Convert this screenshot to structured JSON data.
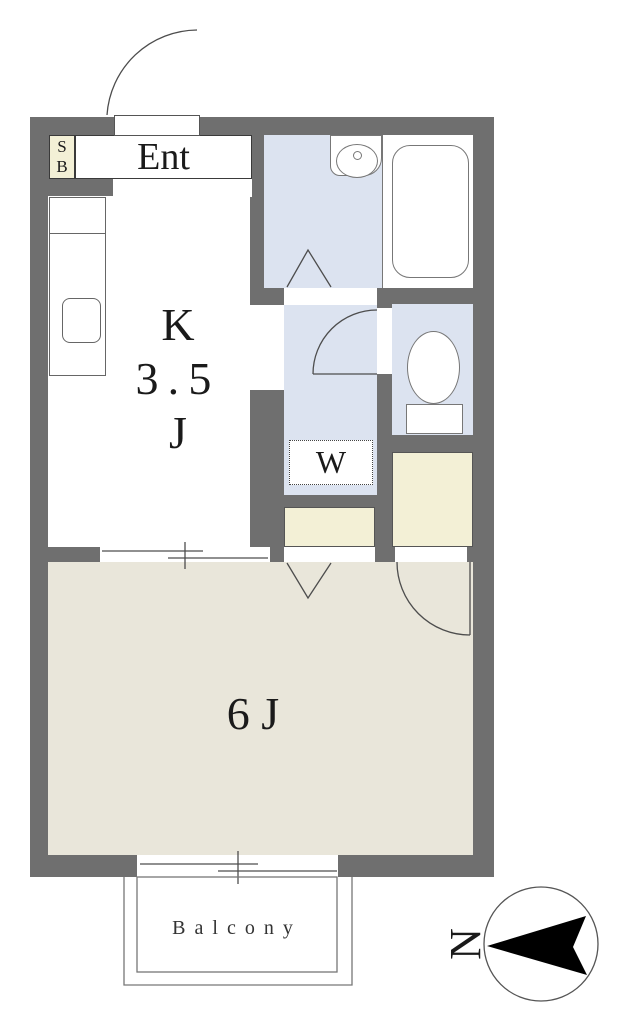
{
  "labels": {
    "ent": "Ent",
    "sb_top": "S",
    "sb_bottom": "B",
    "kitchen_l1": "K",
    "kitchen_l2": "3.5",
    "kitchen_l3": "J",
    "room6j": "6 J",
    "washer": "W",
    "balcony": "Balcony",
    "north": "N"
  },
  "colors": {
    "wall": "#6f6f6f",
    "wet_area_floor": "#dce3f0",
    "storage_fill": "#f3f0d6",
    "living_floor": "#e9e6da",
    "outline": "#4d4d4d",
    "compass_arrow": "#000000"
  }
}
